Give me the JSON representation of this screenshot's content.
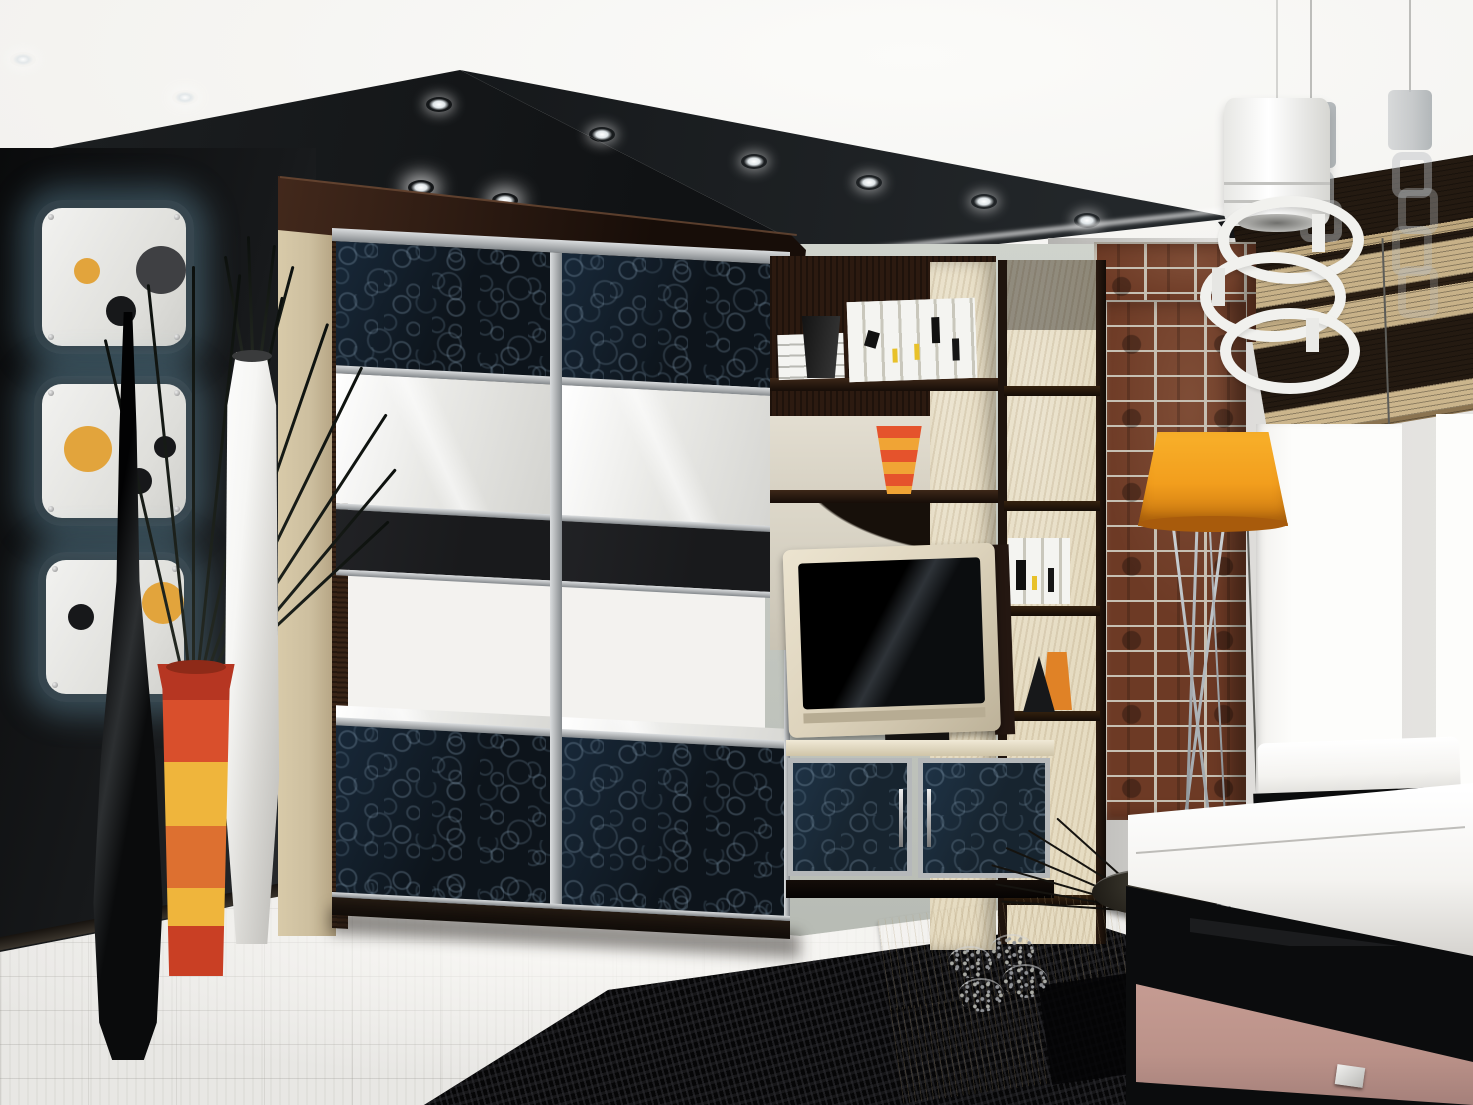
{
  "canvas": {
    "width": 1473,
    "height": 1105
  },
  "scene": {
    "type": "3D interior render, no text",
    "room": "modern living room with sliding-door wardrobe wall unit",
    "objects": [
      {
        "label": "white plaster ceiling with recessed halogen spotlights"
      },
      {
        "label": "black glossy ceiling soffit band sweeping diagonally"
      },
      {
        "label": "white pendant lamp of stacked offset rings on thin cord"
      },
      {
        "label": "two grey translucent pendant lamps"
      },
      {
        "label": "dark charcoal accent wall on the left"
      },
      {
        "label": "three white rounded wall panels with orange and black circles, blue backlight"
      },
      {
        "label": "tall slender glossy black floor vase"
      },
      {
        "label": "tall white ceramic floor vase"
      },
      {
        "label": "red-orange-yellow striped conical floor vase with black grass stems"
      },
      {
        "label": "large sliding-door wardrobe: crocodile-texture black glass, white gloss and black stripe panels, aluminium frame, beige sides, wenge cornice with downlights"
      },
      {
        "label": "beige and wenge open shelving unit with white books marked black and yellow"
      },
      {
        "label": "small orange striped vase on shelf"
      },
      {
        "label": "black cone ornament and orange card on bookcase shelf"
      },
      {
        "label": "stepped white decor object"
      },
      {
        "label": "flat TV with beige frame on wall unit"
      },
      {
        "label": "TV cabinet with two blue crackle-glass doors and chrome handles"
      },
      {
        "label": "red clinker brick column"
      },
      {
        "label": "orange drum-shade floor lamp on chrome tripod"
      },
      {
        "label": "striped bamboo roman blinds, dark brown and tan"
      },
      {
        "label": "bright white window with white frame posts"
      },
      {
        "label": "white window bench cushion on black base"
      },
      {
        "label": "white leather sofa armrest"
      },
      {
        "label": "black sideboard with dusty-pink drawer front and chrome handle"
      },
      {
        "label": "low light-birch coffee table"
      },
      {
        "label": "black bowl with long dark sticks, four small patterned bowls"
      },
      {
        "label": "black high-pile shag rug"
      },
      {
        "label": "whitewashed light parquet floor"
      }
    ]
  },
  "palette": {
    "ceiling_white": "#f3f2ef",
    "ceiling_black": "#101214",
    "ceiling_black2": "#1d2022",
    "leftwall_dark": "#0a0b0c",
    "leftwall_light": "#2b2e30",
    "rightwall": "#d8d7d4",
    "midwall": "#c5c9c2",
    "glow_blue": "#7fb3c8",
    "panel_white": "#ececea",
    "panel_orange": "#e2a43c",
    "panel_darkgrey": "#3f4043",
    "panel_black": "#17181a",
    "wardrobe_side": "#cdbf9f",
    "wenge": "#2c1a10",
    "cornice_hi": "#6b4a34",
    "door_white": "#e9e9e6",
    "door_black": "#191a1c",
    "crackle_base": "#0d141b",
    "aluminum": "#b5b8ba",
    "unit_beige": "#e6dcc2",
    "book_white": "#f4f4f1",
    "book_yellow": "#e8c12a",
    "vase_red": "#d94f2c",
    "vase_yellow": "#efb53c",
    "vase_orange2": "#dd7030",
    "vase_rim": "#b63622",
    "tv_frame": "#ddd3bc",
    "tv_screen": "#0b0d0f",
    "cabinet_glass": "#17242f",
    "brick": "#6d3a25",
    "mortar": "#c6bfb2",
    "lamp_orange": "#f29e1d",
    "lamp_rim": "#a85b0c",
    "chrome": "#aeb4b8",
    "blind_dark": "#241a11",
    "blind_tan": "#c7b188",
    "window_white": "#fdfdfb",
    "sofa_white": "#f4f3f0",
    "black_furniture": "#0b0c0d",
    "drawer_pink": "#bb9289",
    "table_wood": "#ece2c6",
    "rug_black": "#060607",
    "floor_light": "#e8e7e4",
    "grass": "#0c100d",
    "stick": "#15130f",
    "vase_black": "#0a0b0c",
    "vase_white": "#f6f6f4"
  }
}
